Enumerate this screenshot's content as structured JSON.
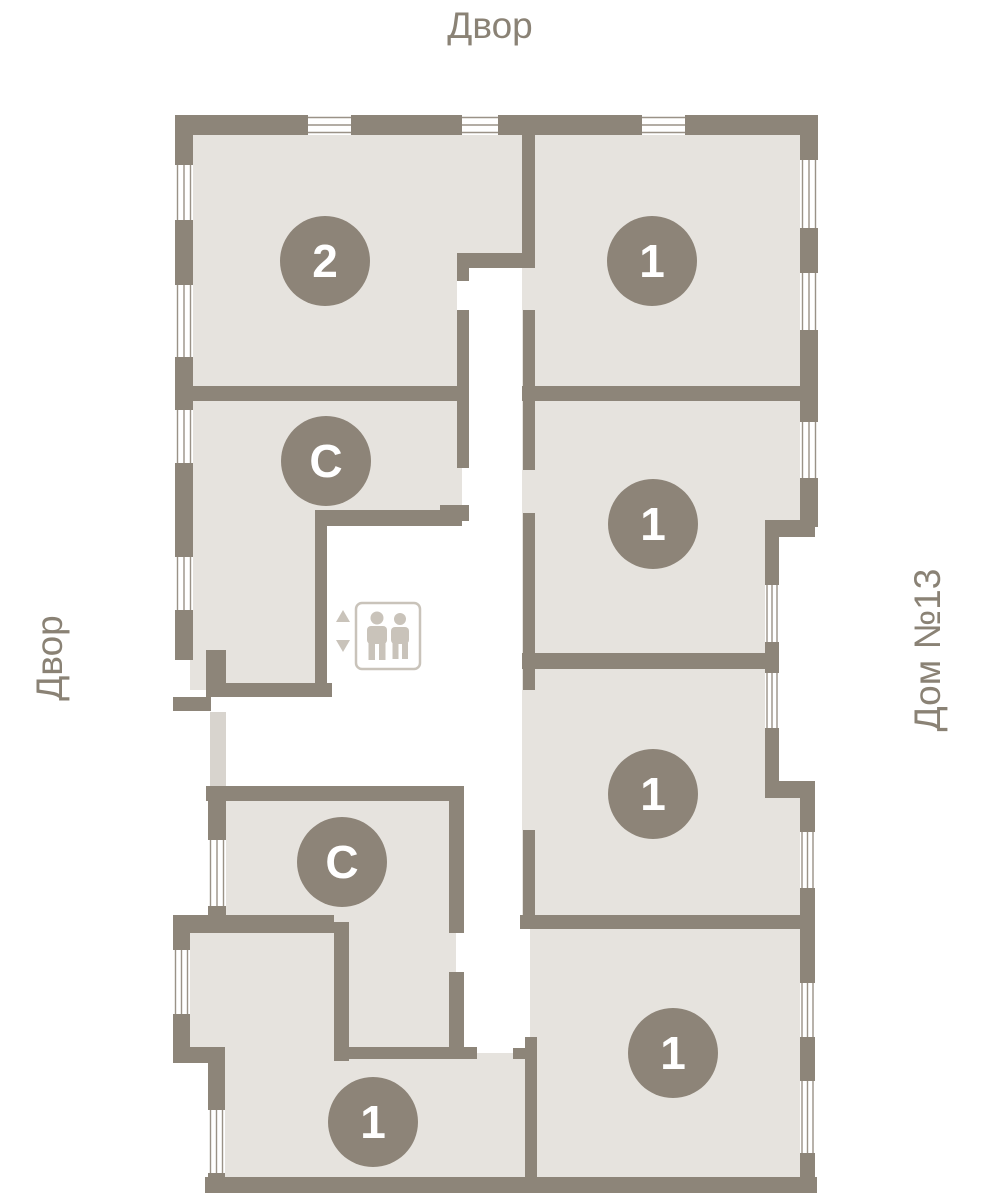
{
  "plan": {
    "label_top": "Двор",
    "label_left": "Двор",
    "label_right": "Дом №13"
  },
  "colors": {
    "wall": "#8d8579",
    "room": "#e6e3de",
    "band": "#d8d4ce",
    "badge": "#8d8478",
    "badge_text": "#ffffff",
    "label_text": "#8a8275",
    "window_line": "#9a9287",
    "elevator": "#c9c3ba"
  },
  "apartments": [
    {
      "id": "apt-2-top-left",
      "label": "2"
    },
    {
      "id": "apt-1-top-right",
      "label": "1"
    },
    {
      "id": "apt-studio-upper",
      "label": "С"
    },
    {
      "id": "apt-1-right-second",
      "label": "1"
    },
    {
      "id": "apt-1-right-third",
      "label": "1"
    },
    {
      "id": "apt-studio-lower",
      "label": "С"
    },
    {
      "id": "apt-1-bottom-right",
      "label": "1"
    },
    {
      "id": "apt-1-bottom-left",
      "label": "1"
    }
  ]
}
